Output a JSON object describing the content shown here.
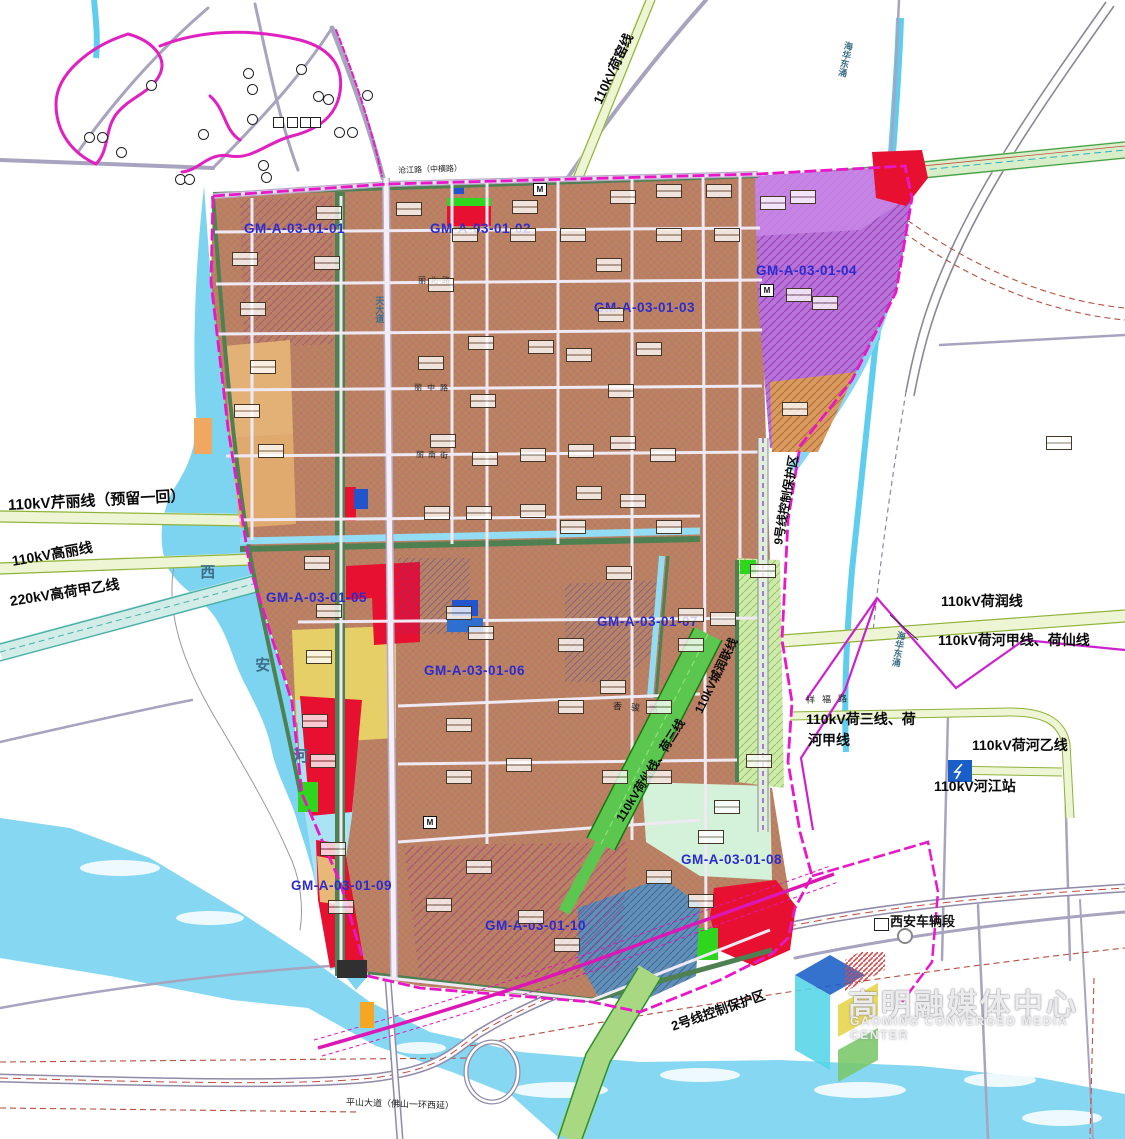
{
  "labels": {
    "parcels": [
      {
        "text": "GM-A-03-01-01",
        "x": 244,
        "y": 221
      },
      {
        "text": "GM-A-03-01-02",
        "x": 430,
        "y": 221
      },
      {
        "text": "GM-A-03-01-03",
        "x": 594,
        "y": 300
      },
      {
        "text": "GM-A-03-01-04",
        "x": 756,
        "y": 263
      },
      {
        "text": "GM-A-03-01-05",
        "x": 266,
        "y": 590
      },
      {
        "text": "GM-A-03-01-06",
        "x": 424,
        "y": 663
      },
      {
        "text": "GM-A-03-01-07",
        "x": 597,
        "y": 614
      },
      {
        "text": "GM-A-03-01-08",
        "x": 681,
        "y": 852
      },
      {
        "text": "GM-A-03-01-09",
        "x": 291,
        "y": 878
      },
      {
        "text": "GM-A-03-01-10",
        "x": 485,
        "y": 918
      }
    ],
    "power": [
      {
        "text": "110kV芹丽线（预留一回）",
        "x": 8,
        "y": 497,
        "rot": -3,
        "size": 15
      },
      {
        "text": "110kV高丽线",
        "x": 12,
        "y": 553,
        "rot": -10,
        "size": 14
      },
      {
        "text": "220kV高荷甲乙线",
        "x": 10,
        "y": 593,
        "rot": -9,
        "size": 14
      },
      {
        "text": "110kV荷窑线",
        "x": 598,
        "y": 96,
        "rot": -65,
        "size": 13
      },
      {
        "text": "110kV荷润线",
        "x": 941,
        "y": 593,
        "rot": 0,
        "size": 14
      },
      {
        "text": "110kV荷河甲线、荷仙线",
        "x": 938,
        "y": 632,
        "rot": 0,
        "size": 14
      },
      {
        "text": "110kV荷三线、荷",
        "x": 806,
        "y": 711,
        "rot": 0,
        "size": 14
      },
      {
        "text": "河甲线",
        "x": 808,
        "y": 732,
        "rot": 0,
        "size": 14
      },
      {
        "text": "110kV荷河乙线",
        "x": 972,
        "y": 737,
        "rot": 0,
        "size": 14
      },
      {
        "text": "110kV河江站",
        "x": 934,
        "y": 778,
        "rot": 0,
        "size": 14
      },
      {
        "text": "110kV荷仙线、荷三线",
        "x": 620,
        "y": 814,
        "rot": -58,
        "size": 12
      },
      {
        "text": "110kV城润联线",
        "x": 699,
        "y": 706,
        "rot": -64,
        "size": 12
      },
      {
        "text": "9号线控制保护区",
        "x": 779,
        "y": 538,
        "rot": -80,
        "size": 12
      },
      {
        "text": "2号线控制保护区",
        "x": 672,
        "y": 1020,
        "rot": -19,
        "size": 13
      }
    ],
    "roads": [
      {
        "text": "沧江路（中横路）",
        "x": 398,
        "y": 166,
        "rot": -2,
        "size": 8
      },
      {
        "text": "丽北路",
        "x": 418,
        "y": 276,
        "rot": 0,
        "size": 8,
        "ls": 4
      },
      {
        "text": "丽中路",
        "x": 414,
        "y": 383,
        "rot": 1,
        "size": 8,
        "ls": 5
      },
      {
        "text": "丽南街",
        "x": 416,
        "y": 450,
        "rot": 2,
        "size": 8,
        "ls": 4
      },
      {
        "text": "香骏路",
        "x": 613,
        "y": 701,
        "rot": 4,
        "size": 9,
        "ls": 9
      },
      {
        "text": "祥福路",
        "x": 806,
        "y": 695,
        "rot": -2,
        "size": 9,
        "ls": 7
      },
      {
        "text": "平山大道（佛山一环西延）",
        "x": 346,
        "y": 1097,
        "rot": 2,
        "size": 9
      }
    ],
    "vertical": [
      {
        "text": "天大道",
        "x": 374,
        "y": 296,
        "size": 9
      },
      {
        "text": "海华东涌",
        "x": 840,
        "y": 40,
        "size": 9,
        "rot": 12
      },
      {
        "text": "海华东涌",
        "x": 893,
        "y": 630,
        "size": 9,
        "rot": 10
      },
      {
        "text": "西",
        "x": 198,
        "y": 564,
        "size": 15
      },
      {
        "text": "安",
        "x": 253,
        "y": 657,
        "size": 15
      },
      {
        "text": "河",
        "x": 291,
        "y": 748,
        "size": 15
      }
    ],
    "facility": [
      {
        "text": "西安车辆段",
        "x": 890,
        "y": 915,
        "size": 13
      }
    ]
  },
  "watermark": {
    "zh": "高明融媒体中心",
    "en": "GAOMING CONVERGED MEDIA CENTER"
  },
  "icons": {
    "metro_text": "M",
    "metro_positions": [
      [
        533,
        183
      ],
      [
        760,
        284
      ],
      [
        423,
        816
      ]
    ]
  },
  "decor": {
    "block_boxes": [
      [
        232,
        252
      ],
      [
        240,
        302
      ],
      [
        250,
        360
      ],
      [
        234,
        404
      ],
      [
        258,
        444
      ],
      [
        316,
        206
      ],
      [
        314,
        256
      ],
      [
        396,
        202
      ],
      [
        452,
        228
      ],
      [
        428,
        278
      ],
      [
        512,
        200
      ],
      [
        510,
        228
      ],
      [
        560,
        228
      ],
      [
        610,
        190
      ],
      [
        656,
        184
      ],
      [
        706,
        184
      ],
      [
        656,
        228
      ],
      [
        714,
        228
      ],
      [
        760,
        196
      ],
      [
        786,
        288
      ],
      [
        782,
        402
      ],
      [
        596,
        258
      ],
      [
        598,
        308
      ],
      [
        636,
        342
      ],
      [
        566,
        348
      ],
      [
        608,
        384
      ],
      [
        528,
        340
      ],
      [
        468,
        336
      ],
      [
        418,
        356
      ],
      [
        470,
        394
      ],
      [
        430,
        434
      ],
      [
        472,
        452
      ],
      [
        520,
        448
      ],
      [
        568,
        444
      ],
      [
        610,
        436
      ],
      [
        650,
        448
      ],
      [
        576,
        486
      ],
      [
        620,
        494
      ],
      [
        520,
        504
      ],
      [
        606,
        566
      ],
      [
        750,
        564
      ],
      [
        304,
        556
      ],
      [
        316,
        604
      ],
      [
        306,
        650
      ],
      [
        424,
        506
      ],
      [
        466,
        506
      ],
      [
        560,
        520
      ],
      [
        656,
        520
      ],
      [
        446,
        606
      ],
      [
        468,
        626
      ],
      [
        558,
        638
      ],
      [
        600,
        680
      ],
      [
        646,
        700
      ],
      [
        602,
        770
      ],
      [
        646,
        770
      ],
      [
        446,
        718
      ],
      [
        446,
        770
      ],
      [
        506,
        758
      ],
      [
        558,
        700
      ],
      [
        698,
        830
      ],
      [
        714,
        800
      ],
      [
        746,
        754
      ],
      [
        678,
        608
      ],
      [
        710,
        612
      ],
      [
        678,
        638
      ],
      [
        302,
        714
      ],
      [
        310,
        754
      ],
      [
        320,
        842
      ],
      [
        328,
        900
      ],
      [
        518,
        910
      ],
      [
        554,
        938
      ],
      [
        646,
        870
      ],
      [
        426,
        898
      ],
      [
        466,
        860
      ],
      [
        688,
        894
      ],
      [
        1046,
        436
      ],
      [
        812,
        296
      ],
      [
        790,
        190
      ]
    ],
    "park_icons": [
      [
        146,
        80
      ],
      [
        84,
        132
      ],
      [
        97,
        132
      ],
      [
        116,
        147
      ],
      [
        243,
        68
      ],
      [
        247,
        84
      ],
      [
        296,
        64
      ],
      [
        313,
        91
      ],
      [
        323,
        94
      ],
      [
        247,
        114
      ],
      [
        198,
        129
      ],
      [
        258,
        160
      ],
      [
        261,
        172
      ],
      [
        175,
        174
      ],
      [
        184,
        174
      ],
      [
        334,
        127
      ],
      [
        347,
        127
      ],
      [
        362,
        90
      ]
    ],
    "park_squares": [
      [
        273,
        117
      ],
      [
        287,
        117
      ],
      [
        300,
        117
      ],
      [
        310,
        117
      ]
    ]
  },
  "colors": {
    "boundary_magenta": "#e818c8",
    "parcel_text": "#2b2bd0",
    "water_cyan": "#86d8f2",
    "urban_brown": "#b5885c",
    "zone_purple": "#b873d8",
    "zone_yellow": "#e7cf68",
    "zone_red": "#e81030",
    "zone_mint": "#d4f1da",
    "zone_steelblue": "#6090b8",
    "corridor_green": "#8fb33c",
    "metro_magenta": "#dd17b5"
  }
}
